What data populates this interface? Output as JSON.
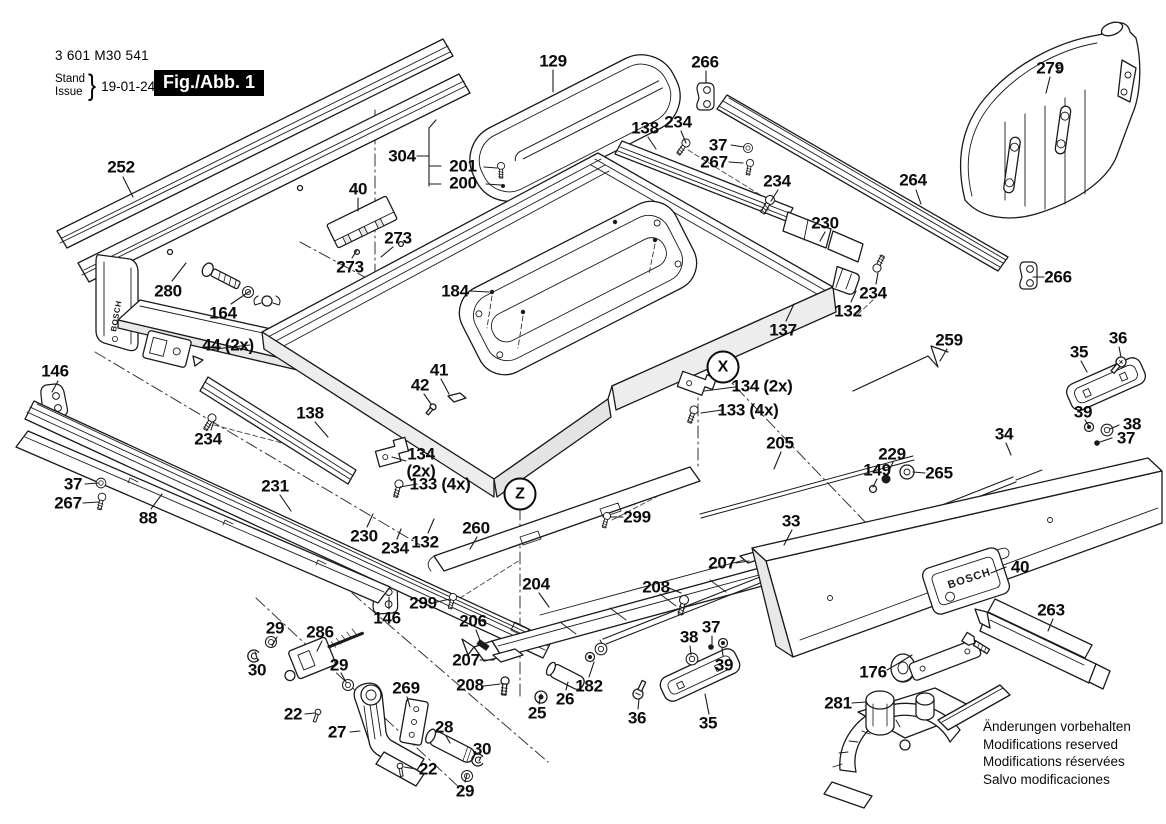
{
  "header": {
    "part_number": "3 601 M30 541",
    "stand_label": "Stand",
    "issue_label": "Issue",
    "brace": "}",
    "date": "19-01-24",
    "figure_label": "Fig./Abb. 1"
  },
  "brand": "BOSCH",
  "footer": {
    "notes": [
      "Änderungen vorbehalten",
      "Modifications reserved",
      "Modifications réservées",
      "Salvo modificaciones"
    ]
  },
  "markers": [
    {
      "text": "X",
      "x": 723,
      "y": 367
    },
    {
      "text": "Z",
      "x": 520,
      "y": 494
    }
  ],
  "callouts": [
    {
      "text": "252",
      "x": 121,
      "y": 167
    },
    {
      "text": "280",
      "x": 168,
      "y": 291
    },
    {
      "text": "164",
      "x": 223,
      "y": 313
    },
    {
      "text": "44 (2x)",
      "x": 228,
      "y": 345
    },
    {
      "text": "146",
      "x": 55,
      "y": 371
    },
    {
      "text": "40",
      "x": 358,
      "y": 189
    },
    {
      "text": "273",
      "x": 398,
      "y": 238
    },
    {
      "text": "273",
      "x": 350,
      "y": 267
    },
    {
      "text": "304",
      "x": 402,
      "y": 156
    },
    {
      "text": "201",
      "x": 463,
      "y": 166
    },
    {
      "text": "200",
      "x": 463,
      "y": 183
    },
    {
      "text": "129",
      "x": 553,
      "y": 61
    },
    {
      "text": "266",
      "x": 705,
      "y": 62
    },
    {
      "text": "138",
      "x": 645,
      "y": 128
    },
    {
      "text": "234",
      "x": 678,
      "y": 122
    },
    {
      "text": "37",
      "x": 718,
      "y": 145
    },
    {
      "text": "267",
      "x": 714,
      "y": 162
    },
    {
      "text": "234",
      "x": 777,
      "y": 181
    },
    {
      "text": "230",
      "x": 825,
      "y": 223
    },
    {
      "text": "264",
      "x": 913,
      "y": 180
    },
    {
      "text": "279",
      "x": 1050,
      "y": 68
    },
    {
      "text": "266",
      "x": 1058,
      "y": 277
    },
    {
      "text": "184",
      "x": 455,
      "y": 291
    },
    {
      "text": "41",
      "x": 439,
      "y": 370
    },
    {
      "text": "42",
      "x": 420,
      "y": 385
    },
    {
      "text": "138",
      "x": 310,
      "y": 413
    },
    {
      "text": "234",
      "x": 208,
      "y": 439
    },
    {
      "text": "231",
      "x": 275,
      "y": 486
    },
    {
      "text": "134\n(2x)",
      "x": 421,
      "y": 463
    },
    {
      "text": "133 (4x)",
      "x": 440,
      "y": 484
    },
    {
      "text": "134 (2x)",
      "x": 762,
      "y": 386
    },
    {
      "text": "133 (4x)",
      "x": 748,
      "y": 410
    },
    {
      "text": "137",
      "x": 783,
      "y": 330
    },
    {
      "text": "132",
      "x": 848,
      "y": 311
    },
    {
      "text": "234",
      "x": 873,
      "y": 293
    },
    {
      "text": "132",
      "x": 425,
      "y": 542
    },
    {
      "text": "234",
      "x": 395,
      "y": 548
    },
    {
      "text": "230",
      "x": 364,
      "y": 536
    },
    {
      "text": "260",
      "x": 476,
      "y": 528
    },
    {
      "text": "299",
      "x": 423,
      "y": 603
    },
    {
      "text": "299",
      "x": 637,
      "y": 517
    },
    {
      "text": "205",
      "x": 780,
      "y": 443
    },
    {
      "text": "229",
      "x": 892,
      "y": 454
    },
    {
      "text": "149",
      "x": 877,
      "y": 470
    },
    {
      "text": "265",
      "x": 939,
      "y": 473
    },
    {
      "text": "259",
      "x": 949,
      "y": 340
    },
    {
      "text": "35",
      "x": 1079,
      "y": 352
    },
    {
      "text": "36",
      "x": 1118,
      "y": 338
    },
    {
      "text": "39",
      "x": 1083,
      "y": 412
    },
    {
      "text": "38",
      "x": 1132,
      "y": 424
    },
    {
      "text": "37",
      "x": 1126,
      "y": 438
    },
    {
      "text": "34",
      "x": 1004,
      "y": 434
    },
    {
      "text": "33",
      "x": 791,
      "y": 521
    },
    {
      "text": "37",
      "x": 73,
      "y": 484
    },
    {
      "text": "267",
      "x": 68,
      "y": 503
    },
    {
      "text": "88",
      "x": 148,
      "y": 518
    },
    {
      "text": "146",
      "x": 387,
      "y": 618
    },
    {
      "text": "204",
      "x": 536,
      "y": 584
    },
    {
      "text": "206",
      "x": 473,
      "y": 621
    },
    {
      "text": "207",
      "x": 466,
      "y": 660
    },
    {
      "text": "208",
      "x": 470,
      "y": 685
    },
    {
      "text": "29",
      "x": 275,
      "y": 628
    },
    {
      "text": "30",
      "x": 257,
      "y": 670
    },
    {
      "text": "286",
      "x": 320,
      "y": 632
    },
    {
      "text": "29",
      "x": 339,
      "y": 665
    },
    {
      "text": "22",
      "x": 293,
      "y": 714
    },
    {
      "text": "27",
      "x": 337,
      "y": 732
    },
    {
      "text": "269",
      "x": 406,
      "y": 688
    },
    {
      "text": "28",
      "x": 444,
      "y": 727
    },
    {
      "text": "22",
      "x": 428,
      "y": 769
    },
    {
      "text": "30",
      "x": 482,
      "y": 749
    },
    {
      "text": "29",
      "x": 465,
      "y": 791
    },
    {
      "text": "25",
      "x": 537,
      "y": 713
    },
    {
      "text": "26",
      "x": 565,
      "y": 699
    },
    {
      "text": "182",
      "x": 589,
      "y": 686
    },
    {
      "text": "36",
      "x": 637,
      "y": 718
    },
    {
      "text": "35",
      "x": 708,
      "y": 723
    },
    {
      "text": "38",
      "x": 689,
      "y": 637
    },
    {
      "text": "37",
      "x": 711,
      "y": 627
    },
    {
      "text": "39",
      "x": 724,
      "y": 665
    },
    {
      "text": "207",
      "x": 722,
      "y": 563
    },
    {
      "text": "208",
      "x": 656,
      "y": 587
    },
    {
      "text": "176",
      "x": 873,
      "y": 672
    },
    {
      "text": "281",
      "x": 838,
      "y": 703
    },
    {
      "text": "40",
      "x": 1020,
      "y": 567
    },
    {
      "text": "263",
      "x": 1051,
      "y": 610
    }
  ]
}
